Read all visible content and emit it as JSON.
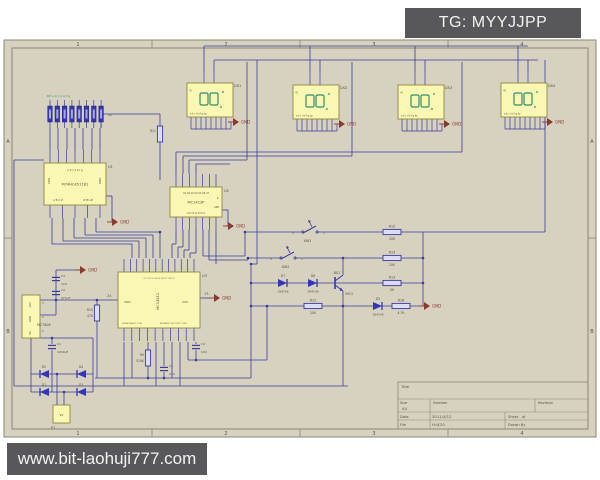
{
  "watermarks": {
    "top_right": "TG: MYYJJPP",
    "bottom_left": "www.bit-laohuji777.com"
  },
  "colors": {
    "page": "#ffffff",
    "sheet": "#d7d2c0",
    "border": "#8b8772",
    "wire": "#3a3a9c",
    "comp_fill": "#faf7b2",
    "comp_stroke": "#8f8545",
    "digit": "#2f8f6f",
    "gnd": "#8a3a2c",
    "text": "#55523f",
    "part_blue": "#3535b5",
    "watermark_bg": "#58585a",
    "watermark_fg": "#f2f2f2"
  },
  "sheet": {
    "zones_h": [
      "1",
      "2",
      "3",
      "4"
    ],
    "zones_v": [
      "A",
      "B"
    ],
    "title_block": {
      "title": "Title",
      "size_label": "Size",
      "size": "A4",
      "number_label": "Number",
      "revision_label": "Revision",
      "date_label": "Date",
      "date": "2011/4/12",
      "sheet_label": "Sheet",
      "of_label": "of",
      "file_label": "File",
      "file": "H:\\K20",
      "drawnby_label": "Drawn By"
    }
  },
  "schematic": {
    "gnd_label": "GND",
    "display_pin_label": "a b c d e f g dp",
    "displays": [
      {
        "x": 187,
        "y": 83,
        "ref": "DS1"
      },
      {
        "x": 293,
        "y": 85,
        "ref": "DS2"
      },
      {
        "x": 398,
        "y": 85,
        "ref": "DS3"
      },
      {
        "x": 501,
        "y": 83,
        "ref": "DS4"
      }
    ],
    "ics": [
      {
        "x": 44,
        "y": 163,
        "w": 62,
        "h": 42,
        "ref": "U1",
        "label": "M74HC4511B1",
        "label_rot": false,
        "pins_top": 7,
        "pins_bottom": 5,
        "texts": [
          {
            "dx": 31,
            "dy": 8,
            "s": "a b c d e f g",
            "size": 2.6,
            "anchor": "middle"
          },
          {
            "dx": 6,
            "dy": 21,
            "s": "VDD",
            "size": 2.8,
            "rot": true
          },
          {
            "dx": 57,
            "dy": 21,
            "s": "GND",
            "size": 2.8,
            "rot": true
          },
          {
            "dx": 14,
            "dy": 38,
            "s": "A B C D",
            "size": 2.6,
            "anchor": "middle"
          },
          {
            "dx": 44,
            "dy": 38,
            "s": "LT BI LE",
            "size": 2.6,
            "anchor": "middle"
          }
        ]
      },
      {
        "x": 170,
        "y": 187,
        "w": 52,
        "h": 30,
        "ref": "U2",
        "label": "MC1413P",
        "label_rot": false,
        "pins_top": 7,
        "pins_bottom": 7,
        "texts": [
          {
            "dx": 26,
            "dy": 7,
            "s": "O1 O2 O3 O4 O5 O6 O7",
            "size": 2.2,
            "anchor": "middle"
          },
          {
            "dx": 26,
            "dy": 27,
            "s": "I1 I2 I3 I4 I5 I6 I7",
            "size": 2.2,
            "anchor": "middle"
          },
          {
            "dx": 47,
            "dy": 12,
            "s": "K",
            "size": 2.4
          },
          {
            "dx": 44,
            "dy": 21,
            "s": "GND",
            "size": 2.2
          }
        ]
      },
      {
        "x": 118,
        "y": 272,
        "w": 82,
        "h": 56,
        "ref": "U3",
        "label": "MC14511",
        "label_rot": true,
        "pins_top": 12,
        "pins_bottom": 10,
        "texts": [
          {
            "dx": 6,
            "dy": 31,
            "s": "VDD",
            "size": 3
          },
          {
            "dx": 64,
            "dy": 31,
            "s": "VSS",
            "size": 3
          },
          {
            "dx": 41,
            "dy": 7,
            "s": "O1 O2 O3 O4 O5 O6 O7 O8 O9",
            "size": 2,
            "anchor": "middle"
          },
          {
            "dx": 4,
            "dy": 52,
            "s": "VDDA VSSA TL CLKI",
            "size": 2
          },
          {
            "dx": 42,
            "dy": 52,
            "s": "RUN BUZ OSCI OSCO CLKO",
            "size": 2
          }
        ]
      }
    ],
    "regulator": {
      "x": 22,
      "y": 295,
      "w": 18,
      "h": 43,
      "label": "MC7806",
      "pin_texts": [
        "+6V",
        "GND",
        "Vin"
      ],
      "pin_nums": [
        "3",
        "2",
        "1"
      ]
    },
    "connector": {
      "x": 53,
      "y": 405,
      "w": 17,
      "h": 18,
      "ref": "P1",
      "label": "9V"
    },
    "resnet": {
      "x": 50,
      "y": 106,
      "cells": 8,
      "top_label": "DP a b c d e f g",
      "side_label": "1K"
    },
    "resistors": [
      {
        "x": 392,
        "y": 232,
        "o": "h",
        "name": "R15",
        "value": "20K"
      },
      {
        "x": 392,
        "y": 258,
        "o": "h",
        "name": "R14",
        "value": "20K"
      },
      {
        "x": 392,
        "y": 283,
        "o": "h",
        "name": "R13",
        "value": "5K"
      },
      {
        "x": 401,
        "y": 306,
        "o": "h",
        "name": "R16",
        "value": "4.7K"
      },
      {
        "x": 313,
        "y": 306,
        "o": "h",
        "name": "R12",
        "value": "20K"
      },
      {
        "x": 97,
        "y": 313,
        "o": "v",
        "name": "R10",
        "value": "47K"
      },
      {
        "x": 148,
        "y": 358,
        "o": "v",
        "name": "R9",
        "value": "510K"
      },
      {
        "x": 160,
        "y": 134,
        "o": "v",
        "name": "R11",
        "value": ""
      }
    ],
    "diodes": [
      {
        "x": 283,
        "y": 283,
        "d": "r",
        "name": "D7",
        "value": "1N4148"
      },
      {
        "x": 313,
        "y": 283,
        "d": "r",
        "name": "D6",
        "value": "1N4148"
      },
      {
        "x": 378,
        "y": 306,
        "d": "r",
        "name": "D5",
        "value": "1N4148"
      },
      {
        "x": 44,
        "y": 374,
        "d": "l",
        "name": "D2",
        "value": ""
      },
      {
        "x": 81,
        "y": 374,
        "d": "l",
        "name": "D4",
        "value": ""
      },
      {
        "x": 44,
        "y": 392,
        "d": "l",
        "name": "D1",
        "value": ""
      },
      {
        "x": 81,
        "y": 392,
        "d": "l",
        "name": "D3",
        "value": ""
      }
    ],
    "capacitors": [
      {
        "x": 56,
        "y": 279,
        "name": "C3",
        "value": "104"
      },
      {
        "x": 56,
        "y": 293,
        "name": "C2",
        "value": "470uF"
      },
      {
        "x": 52,
        "y": 347,
        "name": "C1",
        "value": "2200uF"
      },
      {
        "x": 196,
        "y": 347,
        "name": "C4",
        "value": "104"
      },
      {
        "x": 164,
        "y": 369,
        "name": "C5",
        "value": "104"
      }
    ],
    "switches": [
      {
        "x": 297,
        "y": 232,
        "name": "KW1",
        "pl": "3",
        "pr": "1"
      },
      {
        "x": 275,
        "y": 258,
        "name": "KW2",
        "pl": "3",
        "pr": "1"
      }
    ],
    "transistor": {
      "x": 335,
      "y": 283,
      "name": "BG1",
      "value": "9013"
    },
    "gnds": [
      [
        233,
        122
      ],
      [
        339,
        124
      ],
      [
        444,
        124
      ],
      [
        547,
        122
      ],
      [
        112,
        222
      ],
      [
        228,
        226
      ],
      [
        214,
        298
      ],
      [
        80,
        270
      ],
      [
        424,
        306
      ]
    ],
    "labels": [
      {
        "x": 107,
        "y": 297,
        "s": "24",
        "size": 3.5
      },
      {
        "x": 204,
        "y": 295,
        "s": "13",
        "size": 3.5
      }
    ],
    "wires": [
      [
        204,
        46,
        528,
        46
      ],
      [
        214,
        60,
        538,
        60
      ],
      [
        204,
        46,
        204,
        71
      ],
      [
        214,
        60,
        214,
        71
      ],
      [
        310,
        46,
        310,
        73
      ],
      [
        320,
        60,
        320,
        73
      ],
      [
        415,
        46,
        415,
        73
      ],
      [
        425,
        60,
        425,
        73
      ],
      [
        518,
        46,
        518,
        71
      ],
      [
        528,
        60,
        528,
        71
      ],
      [
        257,
        60,
        257,
        264
      ],
      [
        251,
        264,
        257,
        264
      ],
      [
        251,
        264,
        251,
        378
      ],
      [
        352,
        62,
        352,
        156
      ],
      [
        462,
        62,
        462,
        152
      ],
      [
        545,
        60,
        545,
        232
      ],
      [
        176,
        152,
        462,
        152
      ],
      [
        183,
        156,
        352,
        156
      ],
      [
        189,
        160,
        247,
        160
      ],
      [
        196,
        164,
        230,
        164
      ],
      [
        247,
        62,
        247,
        160
      ],
      [
        176,
        174,
        176,
        152
      ],
      [
        183,
        174,
        183,
        156
      ],
      [
        189,
        174,
        189,
        160
      ],
      [
        196,
        174,
        196,
        164
      ],
      [
        50,
        128,
        50,
        150
      ],
      [
        58,
        128,
        58,
        150
      ],
      [
        67,
        128,
        67,
        150
      ],
      [
        75,
        128,
        75,
        150
      ],
      [
        83,
        128,
        83,
        150
      ],
      [
        92,
        128,
        92,
        150
      ],
      [
        100,
        128,
        100,
        150
      ],
      [
        101,
        128,
        101,
        114
      ],
      [
        101,
        114,
        160,
        114
      ],
      [
        160,
        114,
        160,
        127
      ],
      [
        160,
        141,
        160,
        180
      ],
      [
        52,
        218,
        52,
        244
      ],
      [
        52,
        244,
        132,
        244
      ],
      [
        132,
        244,
        132,
        258
      ],
      [
        63,
        218,
        63,
        241
      ],
      [
        63,
        241,
        139,
        241
      ],
      [
        139,
        241,
        139,
        258
      ],
      [
        74,
        218,
        74,
        238
      ],
      [
        74,
        238,
        146,
        238
      ],
      [
        146,
        238,
        146,
        258
      ],
      [
        85,
        218,
        85,
        235
      ],
      [
        85,
        235,
        153,
        235
      ],
      [
        153,
        235,
        153,
        258
      ],
      [
        96,
        218,
        96,
        232
      ],
      [
        96,
        232,
        160,
        232
      ],
      [
        160,
        232,
        160,
        258
      ],
      [
        106,
        196,
        112,
        196
      ],
      [
        112,
        196,
        112,
        222
      ],
      [
        222,
        210,
        228,
        210
      ],
      [
        228,
        210,
        228,
        226
      ],
      [
        176,
        230,
        176,
        244
      ],
      [
        172,
        244,
        176,
        244
      ],
      [
        172,
        244,
        172,
        258
      ],
      [
        183,
        230,
        183,
        247
      ],
      [
        178,
        247,
        183,
        247
      ],
      [
        178,
        247,
        178,
        258
      ],
      [
        189,
        230,
        189,
        250
      ],
      [
        184,
        250,
        189,
        250
      ],
      [
        184,
        250,
        184,
        258
      ],
      [
        196,
        230,
        196,
        253
      ],
      [
        190,
        253,
        196,
        253
      ],
      [
        190,
        253,
        190,
        258
      ],
      [
        203,
        230,
        203,
        256
      ],
      [
        203,
        256,
        245,
        256
      ],
      [
        245,
        232,
        245,
        256
      ],
      [
        209,
        230,
        209,
        260
      ],
      [
        209,
        260,
        248,
        260
      ],
      [
        248,
        258,
        248,
        260
      ],
      [
        216,
        230,
        216,
        264
      ],
      [
        245,
        232,
        303,
        232
      ],
      [
        317,
        232,
        545,
        232
      ],
      [
        248,
        258,
        281,
        258
      ],
      [
        295,
        258,
        423,
        258
      ],
      [
        251,
        283,
        423,
        283
      ],
      [
        251,
        306,
        423,
        306
      ],
      [
        423,
        232,
        423,
        306
      ],
      [
        343,
        275,
        343,
        258
      ],
      [
        343,
        291,
        343,
        306
      ],
      [
        40,
        300,
        118,
        300
      ],
      [
        200,
        298,
        212,
        298
      ],
      [
        56,
        270,
        56,
        300
      ],
      [
        56,
        270,
        80,
        270
      ],
      [
        56,
        300,
        56,
        315
      ],
      [
        40,
        315,
        56,
        315
      ],
      [
        97,
        300,
        97,
        306
      ],
      [
        97,
        320,
        97,
        378
      ],
      [
        148,
        342,
        148,
        350
      ],
      [
        148,
        366,
        148,
        378
      ],
      [
        164,
        342,
        164,
        366
      ],
      [
        164,
        372,
        164,
        378
      ],
      [
        95,
        378,
        251,
        378
      ],
      [
        196,
        342,
        196,
        344
      ],
      [
        196,
        350,
        196,
        360
      ],
      [
        188,
        360,
        267,
        360
      ],
      [
        267,
        306,
        267,
        360
      ],
      [
        124,
        342,
        124,
        386
      ],
      [
        132,
        342,
        132,
        378
      ],
      [
        156,
        342,
        156,
        386
      ],
      [
        172,
        342,
        172,
        378
      ],
      [
        180,
        342,
        180,
        386
      ],
      [
        188,
        342,
        188,
        360
      ],
      [
        14,
        386,
        348,
        386
      ],
      [
        14,
        160,
        14,
        386
      ],
      [
        14,
        160,
        44,
        160
      ],
      [
        343,
        306,
        343,
        386
      ],
      [
        31,
        338,
        31,
        392
      ],
      [
        31,
        338,
        93,
        338
      ],
      [
        93,
        338,
        93,
        392
      ],
      [
        52,
        338,
        52,
        344
      ],
      [
        52,
        350,
        52,
        392
      ],
      [
        31,
        374,
        93,
        374
      ],
      [
        31,
        392,
        93,
        392
      ],
      [
        57,
        374,
        57,
        405
      ],
      [
        64,
        392,
        64,
        405
      ]
    ],
    "junctions": [
      [
        56,
        300
      ],
      [
        97,
        300
      ],
      [
        148,
        378
      ],
      [
        164,
        378
      ],
      [
        196,
        360
      ],
      [
        267,
        306
      ],
      [
        343,
        306
      ],
      [
        343,
        258
      ],
      [
        423,
        258
      ],
      [
        423,
        283
      ],
      [
        245,
        232
      ],
      [
        248,
        258
      ],
      [
        251,
        283
      ],
      [
        251,
        306
      ],
      [
        251,
        264
      ],
      [
        52,
        338
      ],
      [
        57,
        374
      ],
      [
        64,
        392
      ],
      [
        160,
        232
      ]
    ]
  }
}
